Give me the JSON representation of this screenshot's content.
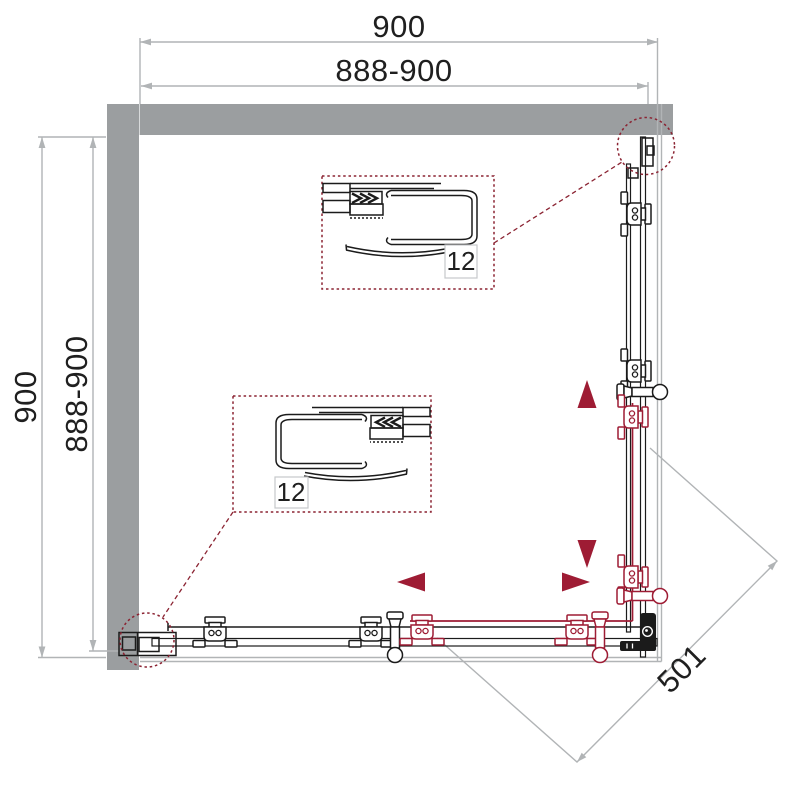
{
  "dimensions": {
    "top_width": "900",
    "top_width_range": "888-900",
    "side_height": "900",
    "side_height_range": "888-900",
    "corner_entry_diagonal": "501"
  },
  "details": {
    "upper_label": "12",
    "lower_label": "12"
  },
  "colors": {
    "wall-gray": "#9b9ea0",
    "dim-gray": "#b1b4b6",
    "line-black": "#1b1b1b",
    "accent-red": "#9e1c34",
    "callout-red": "#8b2332"
  }
}
